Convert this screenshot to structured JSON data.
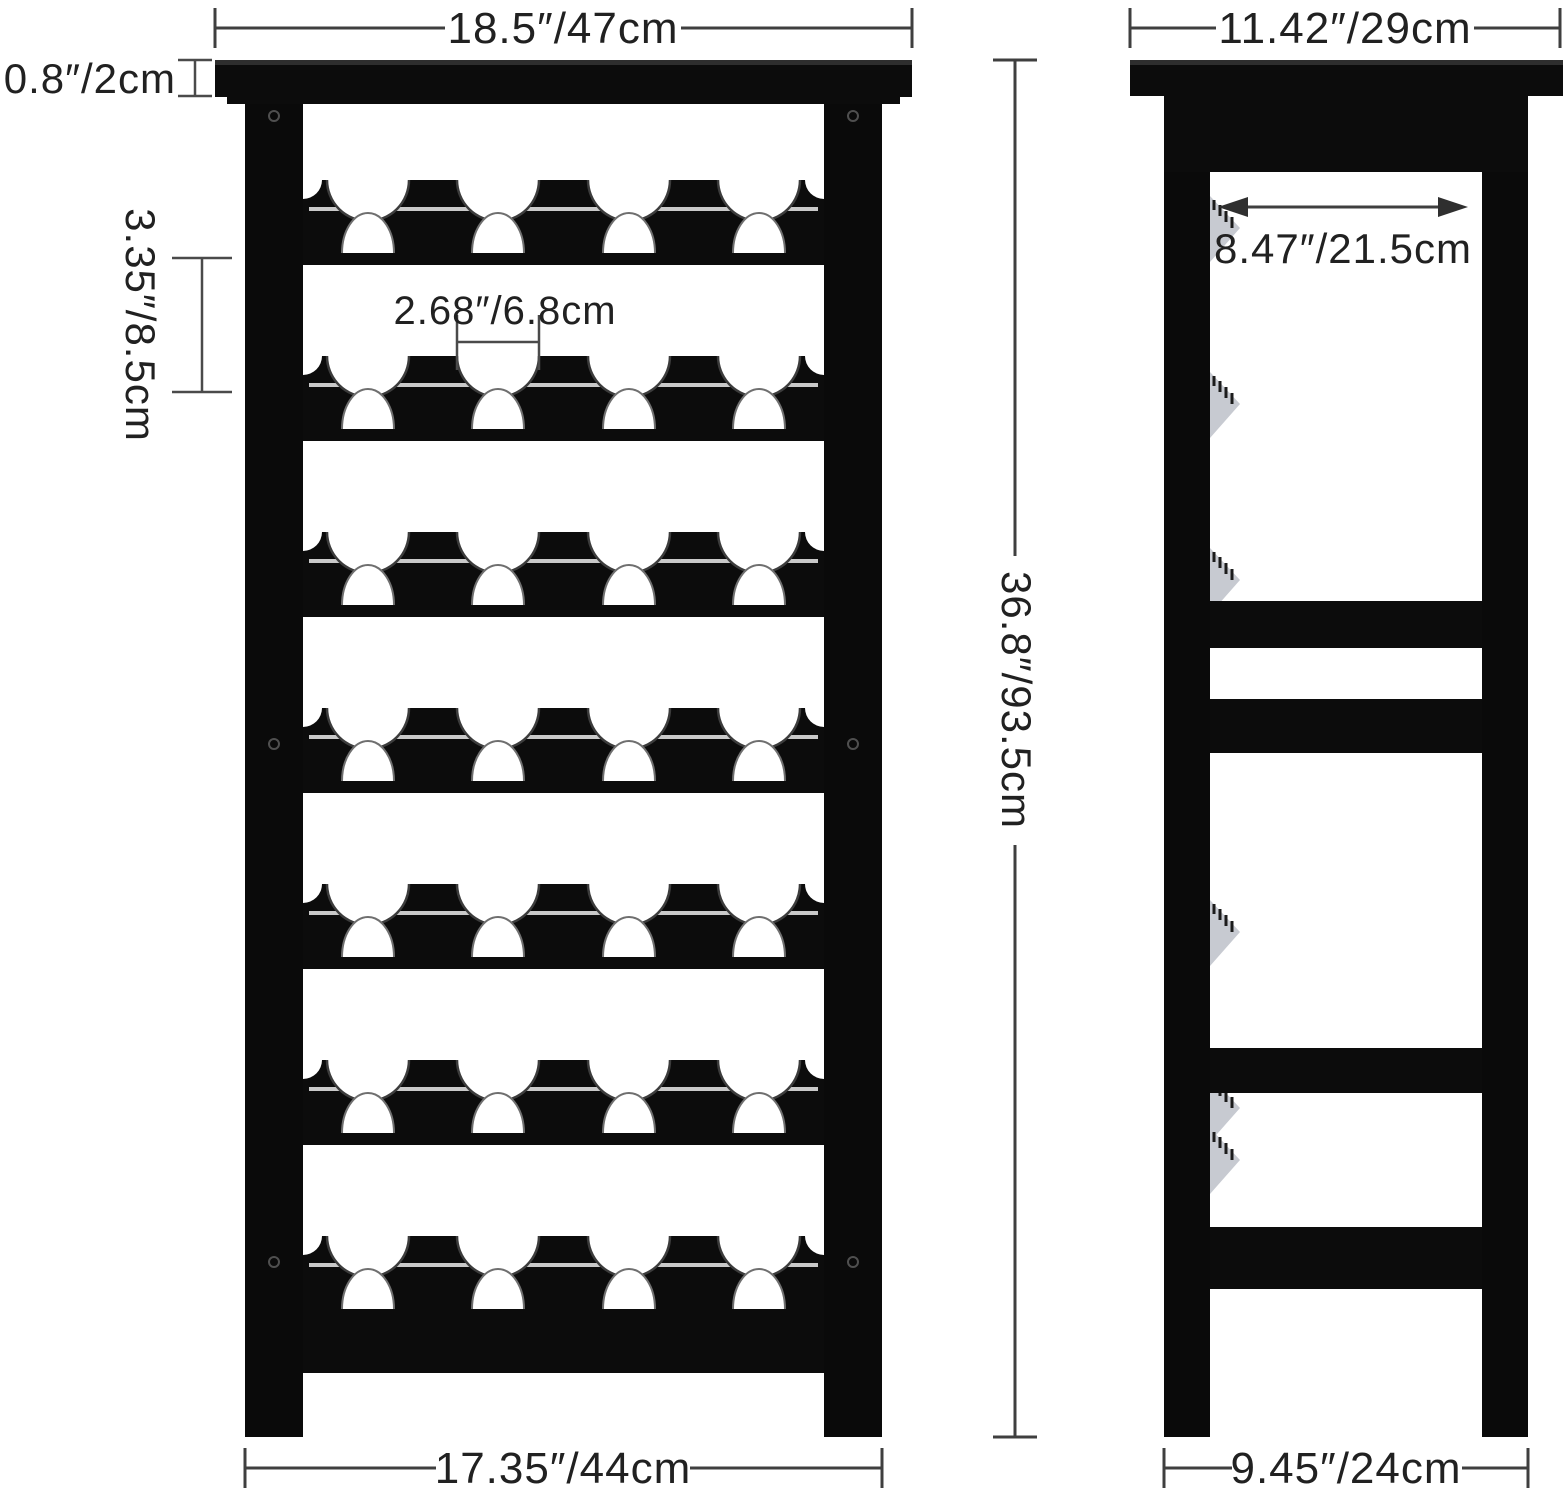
{
  "diagram": {
    "front_view": {
      "top_width_label": "18.5″/47cm",
      "top_thickness_label": "0.8″/2cm",
      "row_spacing_label": "3.35″/8.5cm",
      "slot_width_label": "2.68″/6.8cm",
      "height_label": "36.8″/93.5cm",
      "bottom_width_label": "17.35″/44cm"
    },
    "side_view": {
      "top_depth_label": "11.42″/29cm",
      "inner_depth_label": "8.47″/21.5cm",
      "bottom_depth_label": "9.45″/24cm"
    },
    "colors": {
      "rack": "#0c0c0c",
      "background": "#ffffff",
      "dimension_lines": "#3f3f3f",
      "text": "#212121",
      "rail_end_caps": "#c7cad1"
    }
  }
}
